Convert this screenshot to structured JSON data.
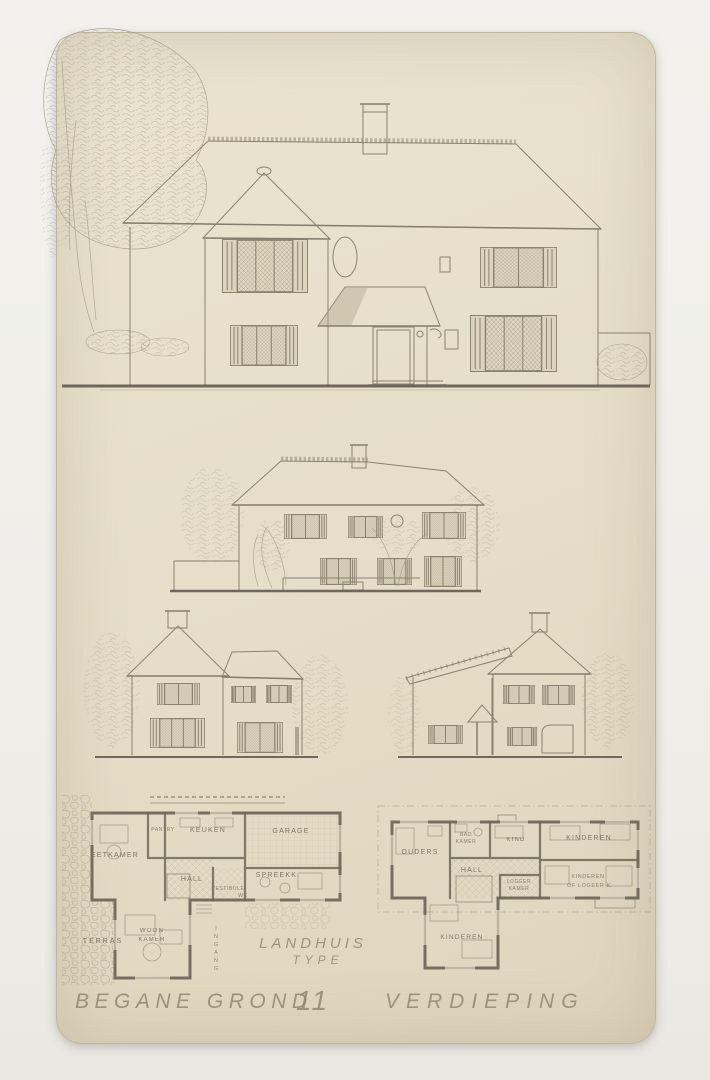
{
  "sheet": {
    "project_title_line1": "LANDHUIS",
    "project_title_line2": "TYPE",
    "type_number": "11",
    "caption_ground_floor": "BEGANE GROND",
    "caption_first_floor": "VERDIEPING"
  },
  "ground_floor_plan": {
    "eetkamer": "EETKAMER",
    "pantry": "PANTRY",
    "keuken": "KEUKEN",
    "garage": "GARAGE",
    "hall": "HALL",
    "spreekkamer": "SPREEKK.",
    "vestibule": "VESTIBULE",
    "wc": "WC",
    "woonkamer_line1": "WOON",
    "woonkamer_line2": "KAMER",
    "terras": "TERRAS",
    "ingang": "INGANG"
  },
  "first_floor_plan": {
    "ouders": "OUDERS",
    "badkamer_line1": "BAD",
    "badkamer_line2": "KAMER",
    "kind": "KIND",
    "kinderen_top": "KINDEREN",
    "hall": "HALL",
    "logeerkamer_line1": "LOGEER",
    "logeerkamer_line2": "KAMER",
    "kinderen_of_logeer_line1": "KINDEREN",
    "kinderen_of_logeer_line2": "OF LOGEER K.",
    "kinderen_bottom": "KINDEREN"
  },
  "colors": {
    "paper": "#e5ddc7",
    "background": "#f0efeb",
    "pencil": "#8b8270",
    "wall_ink": "#665f50"
  }
}
